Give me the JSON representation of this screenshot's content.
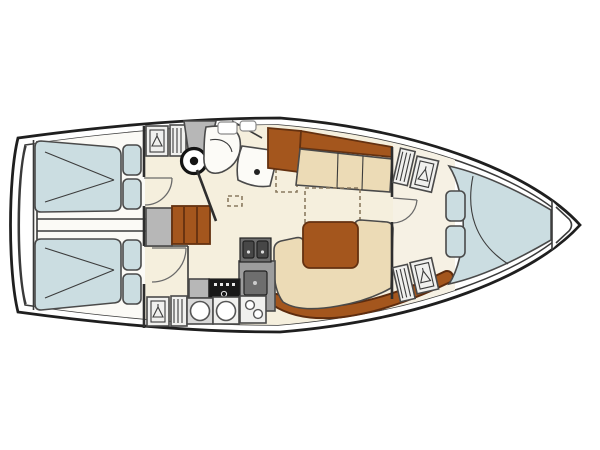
{
  "colors": {
    "hull": "#ffffff",
    "floor_salon": "#f5efdd",
    "floor_aft": "#fbfaf6",
    "floor_fwd": "#f6f1e4",
    "berth_blue": "#cbdde1",
    "settee_cream": "#ecdbb6",
    "wood": "#a4561d",
    "wood_dark": "#7a3c12",
    "gray_light": "#b7b7b7",
    "gray_mid": "#9d9d9d",
    "gray_dark": "#6e6e6e",
    "appliance_black": "#181818",
    "fixture_white": "#fcfbf7",
    "counter_white": "#f0f0ee",
    "locker_frame": "#c9c9c9"
  },
  "icons": {
    "hanger": "coat-hanger-locker",
    "shelves": "shelf-lines-locker",
    "mast": "mast-post-circle",
    "sink": "sink-basin-drain",
    "burners": "stove-burners"
  }
}
